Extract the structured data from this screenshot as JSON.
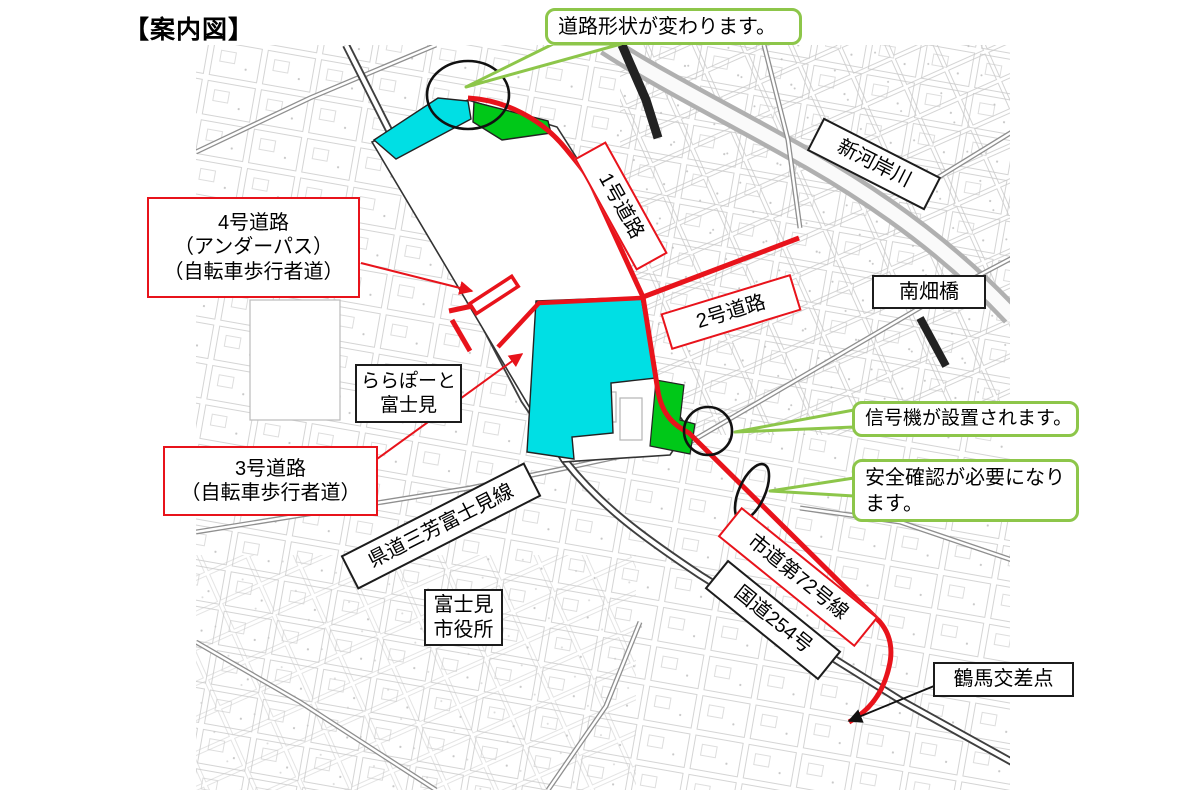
{
  "page": {
    "title": "【案内図】"
  },
  "colors": {
    "road_red": "#e8131b",
    "area_cyan": "#00dfe4",
    "area_green": "#00c818",
    "callout_green_border": "#8dc64a",
    "map_ink": "#3f3f3f"
  },
  "road_labels": {
    "road1": {
      "text": "1号道路"
    },
    "road2": {
      "text": "2号道路"
    },
    "road3": {
      "line1": "3号道路",
      "line2": "（自転車歩行者道）"
    },
    "road4": {
      "line1": "4号道路",
      "line2": "（アンダーパス）",
      "line3": "（自転車歩行者道）"
    },
    "city_road": {
      "text": "市道第72号線"
    },
    "pref_road": {
      "text": "県道三芳富士見線"
    },
    "national_road": {
      "text": "国道254号"
    }
  },
  "place_labels": {
    "river": {
      "text": "新河岸川"
    },
    "bridge": {
      "text": "南畑橋"
    },
    "mall": {
      "line1": "ららぽーと",
      "line2": "富士見"
    },
    "city_hall": {
      "line1": "富士見",
      "line2": "市役所"
    },
    "intersection": {
      "text": "鶴馬交差点"
    }
  },
  "callouts": {
    "road_shape": {
      "text": "道路形状が変わります。"
    },
    "signal": {
      "text": "信号機が設置されます。"
    },
    "safety": {
      "line1": "安全確認が必要になり",
      "line2": "ます。"
    }
  }
}
